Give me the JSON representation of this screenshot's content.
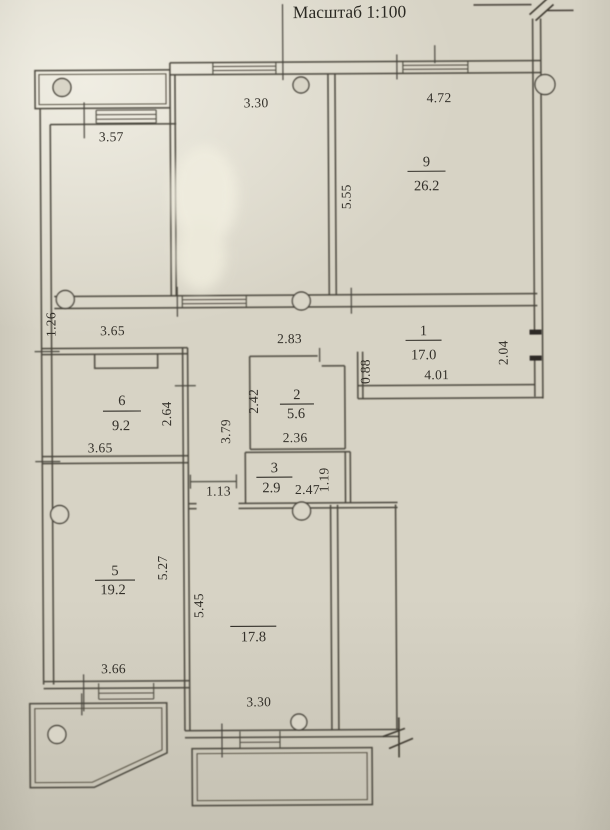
{
  "title": "Масштаб 1:100",
  "rooms": [
    {
      "number": "9",
      "area": "26.2"
    },
    {
      "number": "1",
      "area": "17.0"
    },
    {
      "number": "6",
      "area": "9.2"
    },
    {
      "number": "2",
      "area": "5.6"
    },
    {
      "number": "3",
      "area": "2.9"
    },
    {
      "number": "5",
      "area": "19.2"
    },
    {
      "number": "",
      "area": "17.8"
    }
  ],
  "dimensions": [
    {
      "value": "3.57",
      "orientation": "horizontal"
    },
    {
      "value": "3.30",
      "orientation": "horizontal"
    },
    {
      "value": "4.72",
      "orientation": "horizontal"
    },
    {
      "value": "5.55",
      "orientation": "vertical"
    },
    {
      "value": "1.26",
      "orientation": "vertical"
    },
    {
      "value": "3.65",
      "orientation": "horizontal"
    },
    {
      "value": "2.83",
      "orientation": "horizontal"
    },
    {
      "value": "4.01",
      "orientation": "horizontal"
    },
    {
      "value": "2.04",
      "orientation": "vertical"
    },
    {
      "value": "0.88",
      "orientation": "vertical"
    },
    {
      "value": "2.64",
      "orientation": "vertical"
    },
    {
      "value": "2.42",
      "orientation": "vertical"
    },
    {
      "value": "3.79",
      "orientation": "vertical"
    },
    {
      "value": "2.36",
      "orientation": "horizontal"
    },
    {
      "value": "3.65",
      "orientation": "horizontal"
    },
    {
      "value": "1.13",
      "orientation": "horizontal"
    },
    {
      "value": "2.47",
      "orientation": "horizontal"
    },
    {
      "value": "1.19",
      "orientation": "vertical"
    },
    {
      "value": "5.27",
      "orientation": "vertical"
    },
    {
      "value": "5.45",
      "orientation": "vertical"
    },
    {
      "value": "3.66",
      "orientation": "horizontal"
    },
    {
      "value": "3.30",
      "orientation": "horizontal"
    }
  ],
  "colors": {
    "paper": "#d7d3c5",
    "ink": "#4a463c"
  }
}
